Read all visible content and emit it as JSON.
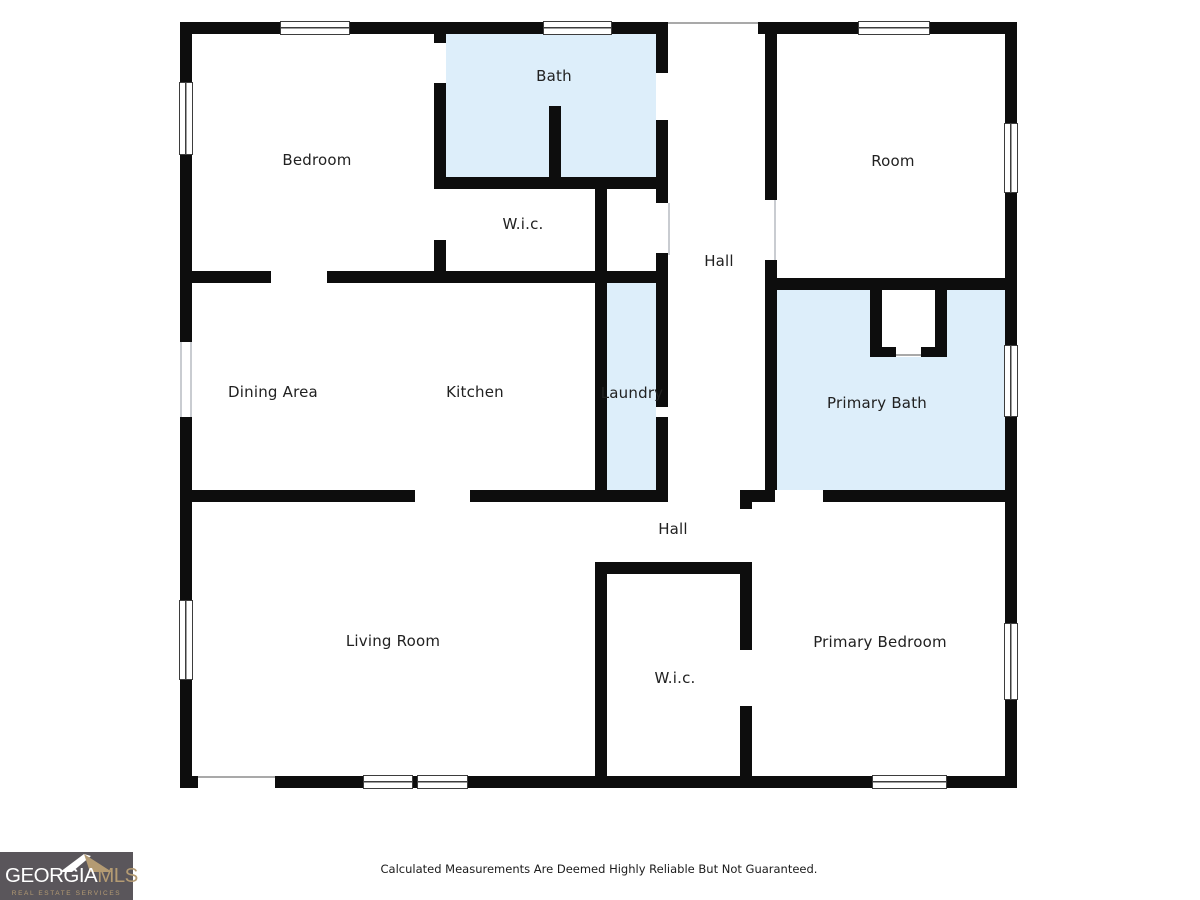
{
  "floor_plan": {
    "rooms": [
      {
        "id": "bedroom",
        "label": "Bedroom",
        "highlight": false
      },
      {
        "id": "bath",
        "label": "Bath",
        "highlight": true
      },
      {
        "id": "room",
        "label": "Room",
        "highlight": false
      },
      {
        "id": "wic-upper",
        "label": "W.i.c.",
        "highlight": false
      },
      {
        "id": "hall-upper",
        "label": "Hall",
        "highlight": false
      },
      {
        "id": "dining-area",
        "label": "Dining Area",
        "highlight": false
      },
      {
        "id": "kitchen",
        "label": "Kitchen",
        "highlight": false
      },
      {
        "id": "laundry",
        "label": "Laundry",
        "highlight": true
      },
      {
        "id": "primary-bath",
        "label": "Primary Bath",
        "highlight": true
      },
      {
        "id": "hall-lower",
        "label": "Hall",
        "highlight": false
      },
      {
        "id": "living-room",
        "label": "Living Room",
        "highlight": false
      },
      {
        "id": "wic-lower",
        "label": "W.i.c.",
        "highlight": false
      },
      {
        "id": "primary-bedroom",
        "label": "Primary Bedroom",
        "highlight": false
      }
    ],
    "colors": {
      "wall": "#0d0d0d",
      "highlight_room": "#ddeefa",
      "window_frame": "#3d3d3d",
      "background": "#ffffff"
    }
  },
  "footer": {
    "disclaimer": "Calculated Measurements Are Deemed Highly Reliable But Not Guaranteed."
  },
  "logo": {
    "brand_primary": "GEORGIA",
    "brand_secondary": "MLS",
    "tagline": "REAL ESTATE SERVICES",
    "background": "#5a565b",
    "accent": "#b49b73"
  }
}
